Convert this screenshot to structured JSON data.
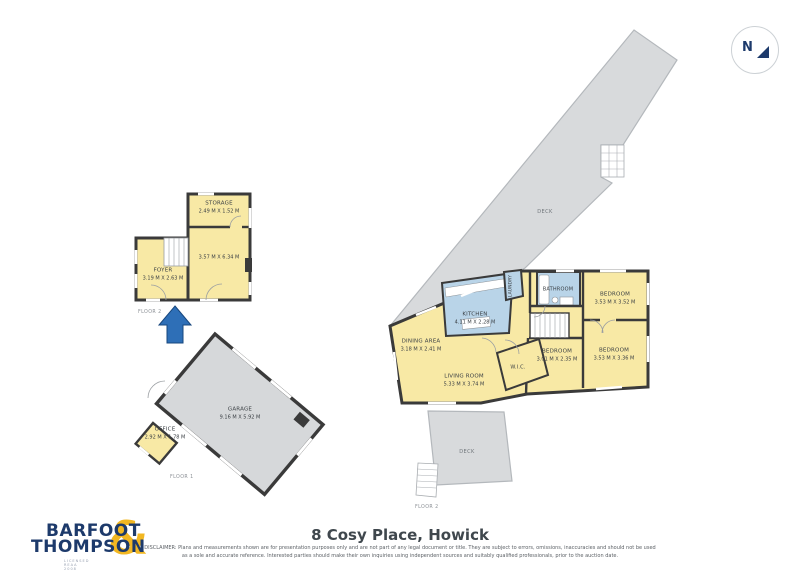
{
  "compass": {
    "north_label": "N"
  },
  "plans": {
    "floor2_upper": {
      "floor_label": "FLOOR 2",
      "rooms": {
        "storage": {
          "name": "STORAGE",
          "dims": "2.49 M X 1.52 M"
        },
        "main_room": {
          "dims": "3.57 M X 6.34 M"
        },
        "foyer": {
          "name": "FOYER",
          "dims": "3.19 M X 2.63 M"
        }
      }
    },
    "floor1": {
      "floor_label": "FLOOR 1",
      "rooms": {
        "garage": {
          "name": "GARAGE",
          "dims": "9.16 M X 5.92 M"
        },
        "office": {
          "name": "OFFICE",
          "dims": "2.92 M X 1.78 M"
        }
      }
    },
    "floor2_main": {
      "floor_label": "FLOOR 2",
      "deck_upper_label": "DECK",
      "deck_lower_label": "DECK",
      "rooms": {
        "kitchen": {
          "name": "KITCHEN",
          "dims": "4.11 M X 2.28 M"
        },
        "dining": {
          "name": "DINING AREA",
          "dims": "3.18 M X 2.41 M"
        },
        "living": {
          "name": "LIVING ROOM",
          "dims": "5.33 M X 3.74 M"
        },
        "laundry": {
          "name": "LAUNDRY"
        },
        "bathroom": {
          "name": "BATHROOM"
        },
        "wic": {
          "name": "W.I.C."
        },
        "bedroom_top_right": {
          "name": "BEDROOM",
          "dims": "3.53 M X 3.52 M"
        },
        "bedroom_bottom_right": {
          "name": "BEDROOM",
          "dims": "3.53 M X 3.36 M"
        },
        "bedroom_middle": {
          "name": "BEDROOM",
          "dims": "3.01 M X 2.35 M"
        }
      }
    }
  },
  "footer": {
    "logo_line1": "BARFOOT",
    "logo_line2": "THOMPSON",
    "logo_ampersand": "&",
    "logo_tagline": "LICENSED REAA 2008",
    "title": "8 Cosy Place, Howick",
    "disclaimer_line1": "DISCLAIMER: Plans and measurements shown are for presentation purposes only and are not part of any legal document or title. They are subject to errors, omissions, inaccuracies and should not be used",
    "disclaimer_line2": "as a sole and accurate reference. Interested parties should make their own inquiries using independent sources and suitably qualified professionals, prior to the auction date."
  },
  "colors": {
    "room_yellow": "#f8e9a5",
    "wet_room_blue": "#b9d4e8",
    "deck_gray": "#d8dadc",
    "wall_dark": "#3a3a3a",
    "brand_navy": "#1d3a6b",
    "brand_gold": "#f2b722",
    "arrow_blue": "#2e6fb7"
  }
}
